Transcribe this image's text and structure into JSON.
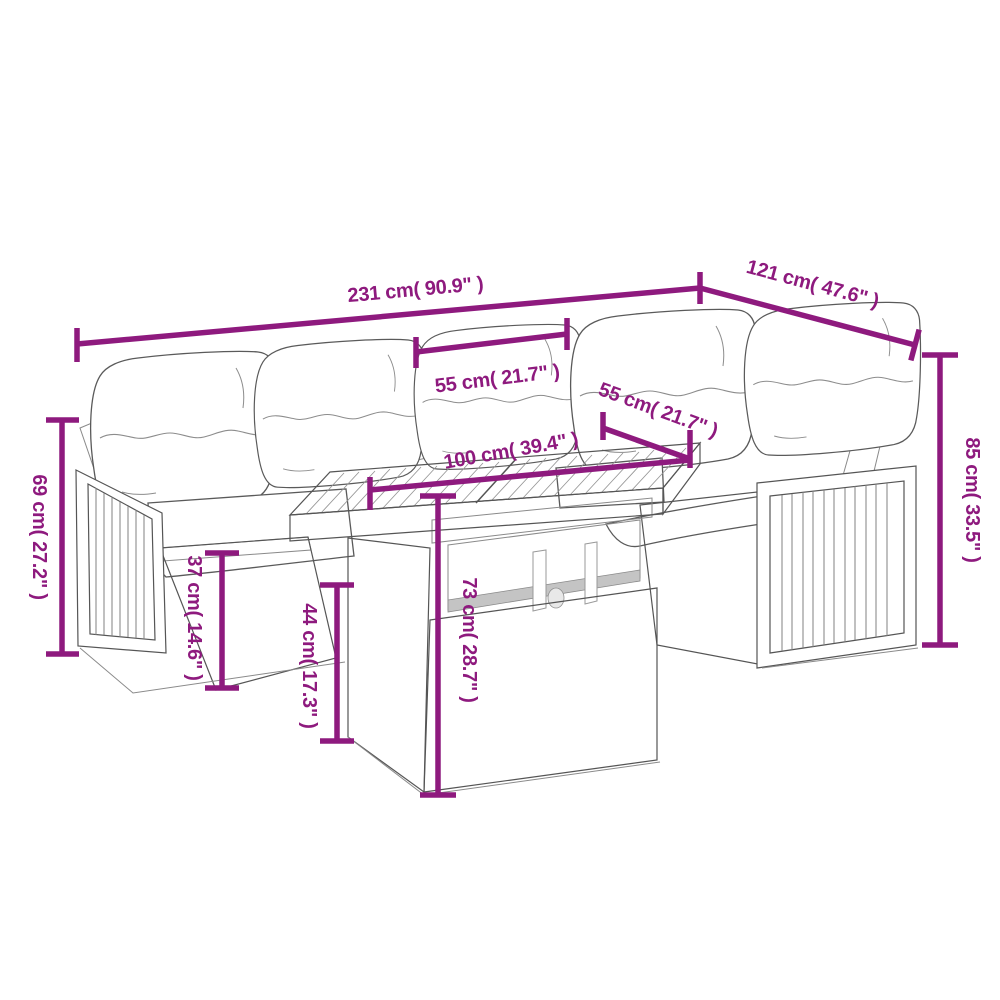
{
  "diagram": {
    "kind": "furniture dimension diagram",
    "subject": "rattan corner sofa set with cushions and slatted-top table",
    "background_color": "#ffffff",
    "dimension_color": "#8E1A7E",
    "artwork_line_color": "#555555"
  },
  "dimensions": {
    "overall_width": {
      "label": "231 cm( 90.9\" )",
      "cm": 231,
      "inches": 90.9
    },
    "overall_depth": {
      "label": "121 cm( 47.6\" )",
      "cm": 121,
      "inches": 47.6
    },
    "seat_width": {
      "label": "55 cm( 21.7\" )",
      "cm": 55,
      "inches": 21.7
    },
    "seat_depth": {
      "label": "55 cm( 21.7\" )",
      "cm": 55,
      "inches": 21.7
    },
    "table_length": {
      "label": "100 cm( 39.4\" )",
      "cm": 100,
      "inches": 39.4
    },
    "armrest_height": {
      "label": "69 cm( 27.2\" )",
      "cm": 69,
      "inches": 27.2
    },
    "seat_height": {
      "label": "37 cm( 14.6\" )",
      "cm": 37,
      "inches": 14.6
    },
    "table_base_height": {
      "label": "44 cm( 17.3\" )",
      "cm": 44,
      "inches": 17.3
    },
    "table_height": {
      "label": "73 cm( 28.7\" )",
      "cm": 73,
      "inches": 28.7
    },
    "back_height": {
      "label": "85 cm( 33.5\" )",
      "cm": 85,
      "inches": 33.5
    }
  }
}
